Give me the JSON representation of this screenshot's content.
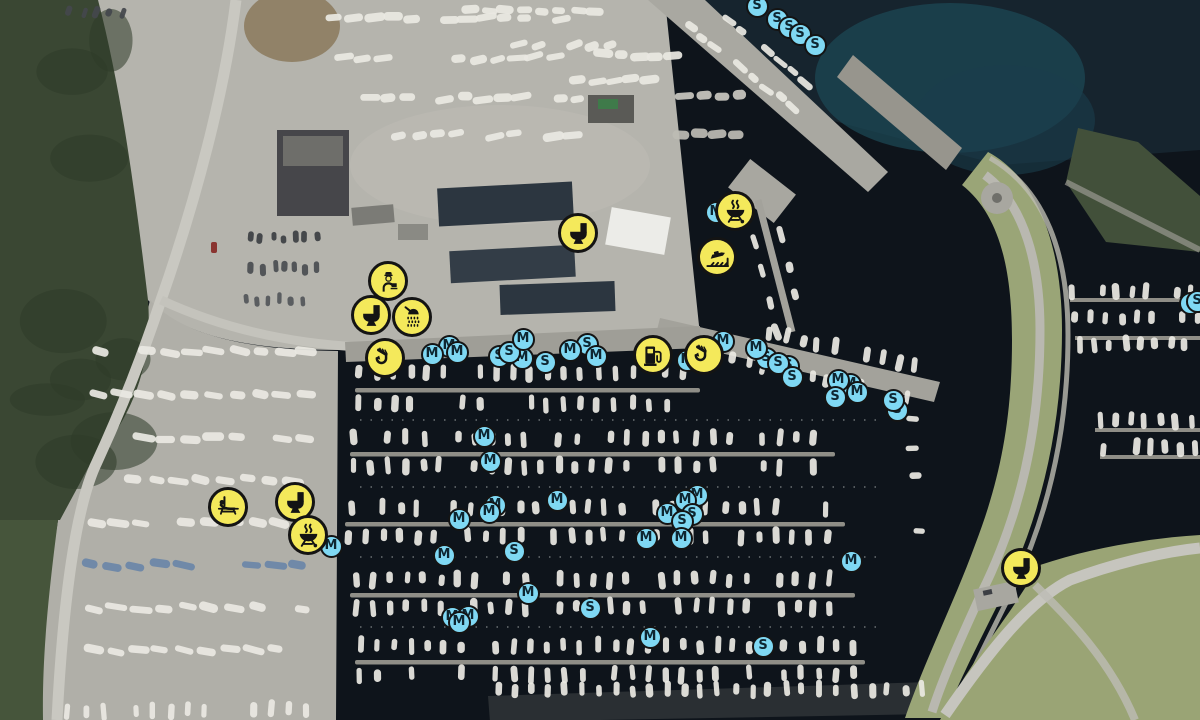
{
  "map": {
    "kind": "satellite-aerial-photo",
    "scene": "marina-harbour-with-boat-yards",
    "marker_styles": {
      "facility": {
        "fill": "#F4E95B",
        "border": "#141414",
        "glyph": "#141414",
        "diameter_px": 40
      },
      "berth": {
        "fill": "#7FD8F3",
        "border": "#141414",
        "letter": "#0E2631",
        "diameter_px": 23
      }
    }
  },
  "markers": {
    "facilities": [
      {
        "icon": "harbour-office-icon",
        "label": "harbour office",
        "x": 388,
        "y": 281
      },
      {
        "icon": "toilet-icon",
        "label": "toilet",
        "x": 371,
        "y": 315
      },
      {
        "icon": "shower-icon",
        "label": "shower",
        "x": 412,
        "y": 317
      },
      {
        "icon": "toilet-icon",
        "label": "toilet",
        "x": 578,
        "y": 233
      },
      {
        "icon": "grill-icon",
        "label": "bbq",
        "x": 735,
        "y": 211
      },
      {
        "icon": "slipway-icon",
        "label": "slipway",
        "x": 717,
        "y": 257
      },
      {
        "icon": "crane-icon",
        "label": "crane",
        "x": 385,
        "y": 358
      },
      {
        "icon": "fuel-icon",
        "label": "fuel",
        "x": 653,
        "y": 355
      },
      {
        "icon": "crane-icon",
        "label": "crane",
        "x": 704,
        "y": 355
      },
      {
        "icon": "lounge-icon",
        "label": "recreation",
        "x": 228,
        "y": 507
      },
      {
        "icon": "toilet-icon",
        "label": "toilet",
        "x": 295,
        "y": 502
      },
      {
        "icon": "grill-icon",
        "label": "bbq",
        "x": 308,
        "y": 535
      },
      {
        "icon": "toilet-icon",
        "label": "toilet",
        "x": 1021,
        "y": 568
      }
    ],
    "berths": [
      {
        "letter": "S",
        "x": 777,
        "y": 19
      },
      {
        "letter": "S",
        "x": 789,
        "y": 27
      },
      {
        "letter": "S",
        "x": 800,
        "y": 34
      },
      {
        "letter": "S",
        "x": 757,
        "y": 6
      },
      {
        "letter": "S",
        "x": 815,
        "y": 45
      },
      {
        "letter": "M",
        "x": 716,
        "y": 212
      },
      {
        "letter": "M",
        "x": 723,
        "y": 341
      },
      {
        "letter": "M",
        "x": 687,
        "y": 360
      },
      {
        "letter": "M",
        "x": 449,
        "y": 346
      },
      {
        "letter": "M",
        "x": 457,
        "y": 352
      },
      {
        "letter": "M",
        "x": 432,
        "y": 354
      },
      {
        "letter": "M",
        "x": 522,
        "y": 358
      },
      {
        "letter": "S",
        "x": 499,
        "y": 356
      },
      {
        "letter": "S",
        "x": 509,
        "y": 352
      },
      {
        "letter": "M",
        "x": 523,
        "y": 339
      },
      {
        "letter": "S",
        "x": 545,
        "y": 362
      },
      {
        "letter": "S",
        "x": 587,
        "y": 344
      },
      {
        "letter": "M",
        "x": 570,
        "y": 350
      },
      {
        "letter": "M",
        "x": 596,
        "y": 356
      },
      {
        "letter": "S",
        "x": 766,
        "y": 358
      },
      {
        "letter": "S",
        "x": 788,
        "y": 366
      },
      {
        "letter": "M",
        "x": 756,
        "y": 348
      },
      {
        "letter": "S",
        "x": 778,
        "y": 363
      },
      {
        "letter": "S",
        "x": 792,
        "y": 377
      },
      {
        "letter": "M",
        "x": 850,
        "y": 384
      },
      {
        "letter": "M",
        "x": 838,
        "y": 380
      },
      {
        "letter": "M",
        "x": 857,
        "y": 392
      },
      {
        "letter": "S",
        "x": 835,
        "y": 397
      },
      {
        "letter": "S",
        "x": 897,
        "y": 410
      },
      {
        "letter": "S",
        "x": 893,
        "y": 400
      },
      {
        "letter": "S",
        "x": 1190,
        "y": 303
      },
      {
        "letter": "S",
        "x": 1197,
        "y": 301
      },
      {
        "letter": "M",
        "x": 484,
        "y": 436
      },
      {
        "letter": "M",
        "x": 490,
        "y": 461
      },
      {
        "letter": "M",
        "x": 557,
        "y": 500
      },
      {
        "letter": "M",
        "x": 495,
        "y": 505
      },
      {
        "letter": "M",
        "x": 489,
        "y": 512
      },
      {
        "letter": "M",
        "x": 459,
        "y": 519
      },
      {
        "letter": "M",
        "x": 444,
        "y": 555
      },
      {
        "letter": "S",
        "x": 514,
        "y": 551
      },
      {
        "letter": "M",
        "x": 528,
        "y": 593
      },
      {
        "letter": "S",
        "x": 590,
        "y": 608
      },
      {
        "letter": "M",
        "x": 452,
        "y": 617
      },
      {
        "letter": "M",
        "x": 468,
        "y": 616
      },
      {
        "letter": "M",
        "x": 459,
        "y": 622
      },
      {
        "letter": "M",
        "x": 650,
        "y": 637
      },
      {
        "letter": "S",
        "x": 763,
        "y": 646
      },
      {
        "letter": "M",
        "x": 697,
        "y": 495
      },
      {
        "letter": "M",
        "x": 685,
        "y": 500
      },
      {
        "letter": "S",
        "x": 692,
        "y": 514
      },
      {
        "letter": "M",
        "x": 667,
        "y": 513
      },
      {
        "letter": "S",
        "x": 682,
        "y": 521
      },
      {
        "letter": "M",
        "x": 681,
        "y": 538
      },
      {
        "letter": "M",
        "x": 646,
        "y": 538
      },
      {
        "letter": "M",
        "x": 851,
        "y": 561
      },
      {
        "letter": "M",
        "x": 331,
        "y": 546
      }
    ]
  }
}
